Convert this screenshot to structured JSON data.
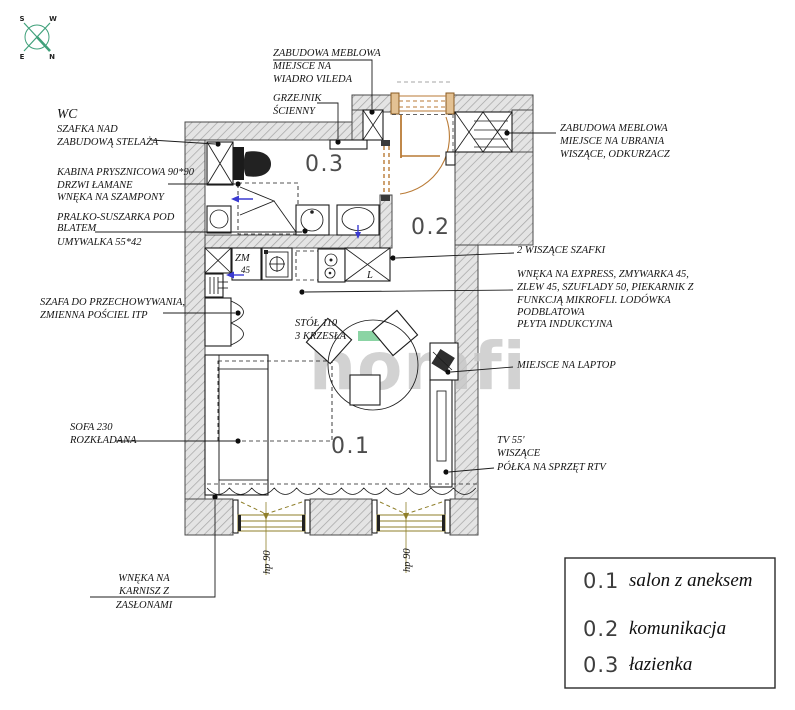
{
  "compass": {
    "s": "S",
    "w": "W",
    "e": "E",
    "n": "N"
  },
  "watermark": {
    "text": "homfi",
    "accent_color": "#8bd4a4",
    "text_color": "#c7c7c7"
  },
  "room_labels": {
    "living": "0.1",
    "hall": "0.2",
    "bathroom": "0.3"
  },
  "annotations": {
    "wc_title": "WC",
    "wc_cabinet": {
      "l1": "SZAFKA NAD",
      "l2": "ZABUDOWĄ STELAŻA"
    },
    "shower": {
      "l1": "KABINA PRYSZNICOWA 90*90",
      "l2": "DRZWI ŁAMANE",
      "l3": "WNĘKA NA SZAMPONY"
    },
    "washer": {
      "l1": "PRALKO-SUSZARKA POD",
      "l2": "BLATEM"
    },
    "basin": "UMYWALKA 55*42",
    "storage": {
      "l1": "SZAFA DO PRZECHOWYWANIA,",
      "l2": "ZMIENNA POŚCIEL ITP"
    },
    "sofa": {
      "l1": "SOFA 230",
      "l2": "ROZKŁADANA"
    },
    "curtain": {
      "l1": "WNĘKA NA",
      "l2": "KARNISZ Z",
      "l3": "ZASŁONAMI"
    },
    "bucket": {
      "l1": "ZABUDOWA MEBLOWA",
      "l2": "MIEJSCE NA",
      "l3": "WIADRO VILEDA"
    },
    "radiator": {
      "l1": "GRZEJNIK",
      "l2": "ŚCIENNY"
    },
    "wardrobe_entry": {
      "l1": "ZABUDOWA MEBLOWA",
      "l2": "MIEJSCE NA UBRANIA",
      "l3": "WISZĄCE, ODKURZACZ"
    },
    "hanging_cabinets": "2 WISZĄCE SZAFKI",
    "kitchen": {
      "l1": "WNĘKA NA EXPRESS, ZMYWARKA 45,",
      "l2": "ZLEW 45, SZUFLADY 50, PIEKARNIK Z",
      "l3": "FUNKCJĄ MIKROFLI. LODÓWKA",
      "l4": "PODBLATOWA",
      "l5": "PŁYTA INDUKCYJNA"
    },
    "laptop": "MIEJSCE NA LAPTOP",
    "tv": {
      "l1": "TV  55'",
      "l2": "WISZĄCE",
      "l3": "PÓŁKA NA SPRZĘT RTV"
    },
    "table": {
      "l1": "STÓŁ  110",
      "l2": "3 KRZESŁA"
    },
    "window_height": "hp 90",
    "dishwasher_zm": "ZM",
    "dishwasher_45": "45",
    "fridge_l": "L"
  },
  "legend": {
    "items": [
      {
        "num": "0.1",
        "label": "salon  z aneksem"
      },
      {
        "num": "0.2",
        "label": "komunikacja"
      },
      {
        "num": "0.3",
        "label": "łazienka"
      }
    ]
  },
  "colors": {
    "door": "#b97a35",
    "window": "#8f7f2a",
    "arrow": "#3b3bd1",
    "compass": "#3fa07a"
  }
}
